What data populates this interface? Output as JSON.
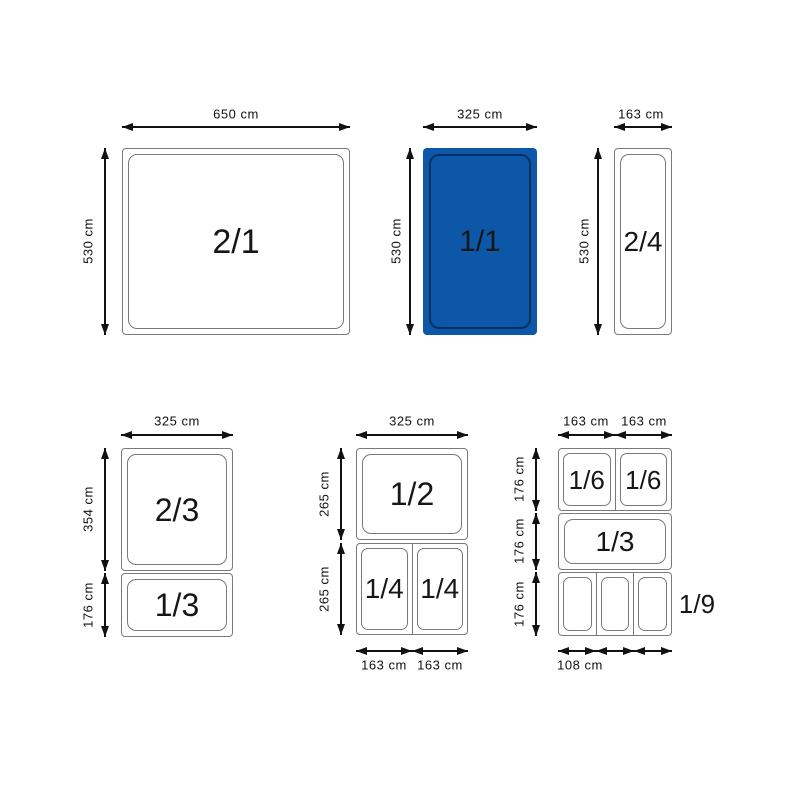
{
  "colors": {
    "highlight_fill": "#0d57a8",
    "highlight_inner_border": "#0a2f5f",
    "pan_border": "#7a7a7a",
    "ink": "#111111"
  },
  "top_row": {
    "pan_2_1": {
      "label": "2/1",
      "top_dim": "650 cm",
      "left_dim": "530 cm"
    },
    "pan_1_1": {
      "label": "1/1",
      "top_dim": "325 cm",
      "left_dim": "530 cm"
    },
    "pan_2_4": {
      "label": "2/4",
      "top_dim": "163 cm",
      "left_dim": "530 cm"
    }
  },
  "bottom_left_group": {
    "top_dim": "325 cm",
    "pan_2_3": {
      "label": "2/3",
      "left_dim": "354 cm"
    },
    "pan_1_3": {
      "label": "1/3",
      "left_dim": "176 cm"
    }
  },
  "bottom_middle_group": {
    "top_dim": "325 cm",
    "pan_1_2": {
      "label": "1/2",
      "left_dim": "265 cm"
    },
    "row_1_4": {
      "left_dim": "265 cm",
      "cell_labels": [
        "1/4",
        "1/4"
      ],
      "bottom_dims": [
        "163 cm",
        "163 cm"
      ]
    }
  },
  "bottom_right_group": {
    "top_dims": [
      "163 cm",
      "163 cm"
    ],
    "row_1_6": {
      "left_dim": "176 cm",
      "cell_labels": [
        "1/6",
        "1/6"
      ]
    },
    "pan_1_3": {
      "label": "1/3",
      "left_dim": "176 cm"
    },
    "row_1_9": {
      "left_dim": "176 cm",
      "side_label": "1/9",
      "bottom_dim": "108 cm"
    }
  }
}
